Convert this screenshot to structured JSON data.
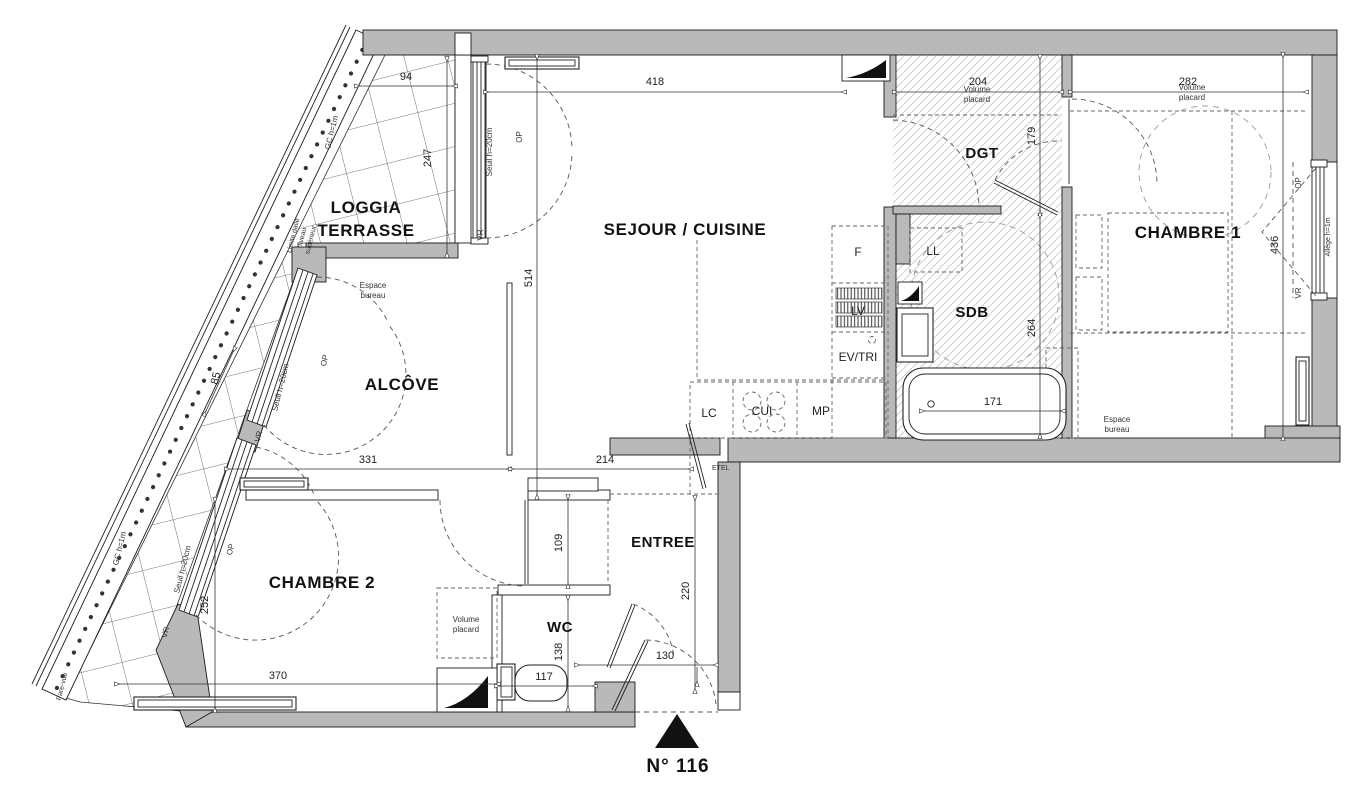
{
  "unit_label": "N° 116",
  "rooms": {
    "loggia_line1": "LOGGIA",
    "loggia_line2": "TERRASSE",
    "sejour": "SEJOUR / CUISINE",
    "dgt": "DGT",
    "chambre1": "CHAMBRE 1",
    "alcove": "ALCÔVE",
    "sdb": "SDB",
    "chambre2": "CHAMBRE 2",
    "entree": "ENTREE",
    "wc": "WC"
  },
  "fixtures": {
    "fridge": "F",
    "lave_linge": "LL",
    "lave_vaisselle": "LV",
    "evier_tri": "EV/TRI",
    "lave_cuisine": "LC",
    "cuisiniere": "CUI",
    "meuble_plan": "MP",
    "etel": "ETEL"
  },
  "annotations": {
    "volume_placard_l1": "Volume",
    "volume_placard_l2": "placard",
    "espace_bureau_l1": "Espace",
    "espace_bureau_l2": "bureau",
    "seuil": "Seuil h=20cm",
    "op": "OP",
    "vr": "VR",
    "allege": "Allège h=1m",
    "garde_corps": "GC h=1m",
    "limite_l1": "Limite dalle",
    "limite_l2": "niveau",
    "limite_l3": "supérieur",
    "pare_vue": "Pare-vue"
  },
  "dimensions": {
    "loggia_w": "94",
    "loggia_h": "247",
    "sejour_w": "418",
    "dgt_w": "204",
    "chambre1_w": "282",
    "dgt_h": "179",
    "sejour_h": "514",
    "chambre1_h": "436",
    "sdb_h": "264",
    "bain_w": "171",
    "diag": "85",
    "alcove_w": "331",
    "passage_w": "214",
    "couloir_h": "109",
    "entree_h": "220",
    "chambre2_h": "252",
    "chambre2_w": "370",
    "wc_w": "117",
    "wc_h": "138",
    "entree_w": "130"
  },
  "colors": {
    "wall_gray": "#b9b9b9",
    "hatch_gray": "#d0d0d0",
    "line_dark": "#1a1a1a"
  }
}
